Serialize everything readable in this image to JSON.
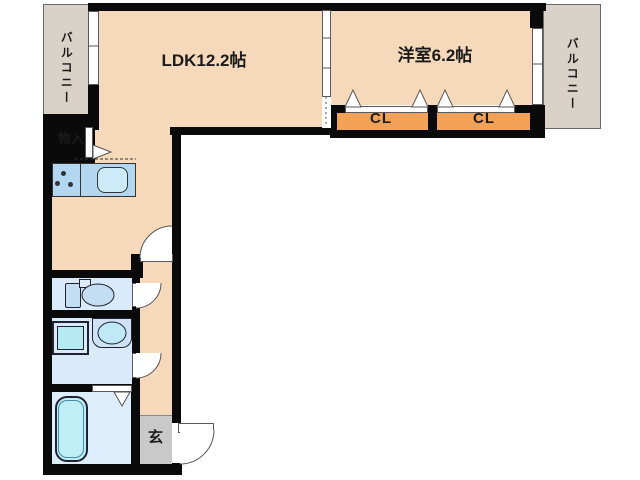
{
  "labels": {
    "ldk": "LDK12.2帖",
    "western": "洋室6.2帖",
    "cl_left": "CL",
    "cl_right": "CL",
    "balcony_left": "バルコニー",
    "balcony_right": "バルコニー",
    "storage": "物入",
    "entrance": "玄"
  },
  "colors": {
    "floor_peach": "#f6d8ba",
    "closet_orange": "#f2a159",
    "balcony_tan": "#d8d2c9",
    "wet_room_blue": "#d9eafa",
    "fixture_blue": "#c3ddf3",
    "water_cyan": "#b5eaf5",
    "counter_blue": "#b4d7f1",
    "entrance_gray": "#c9c9c9",
    "wall_black": "#0a0a0a"
  }
}
